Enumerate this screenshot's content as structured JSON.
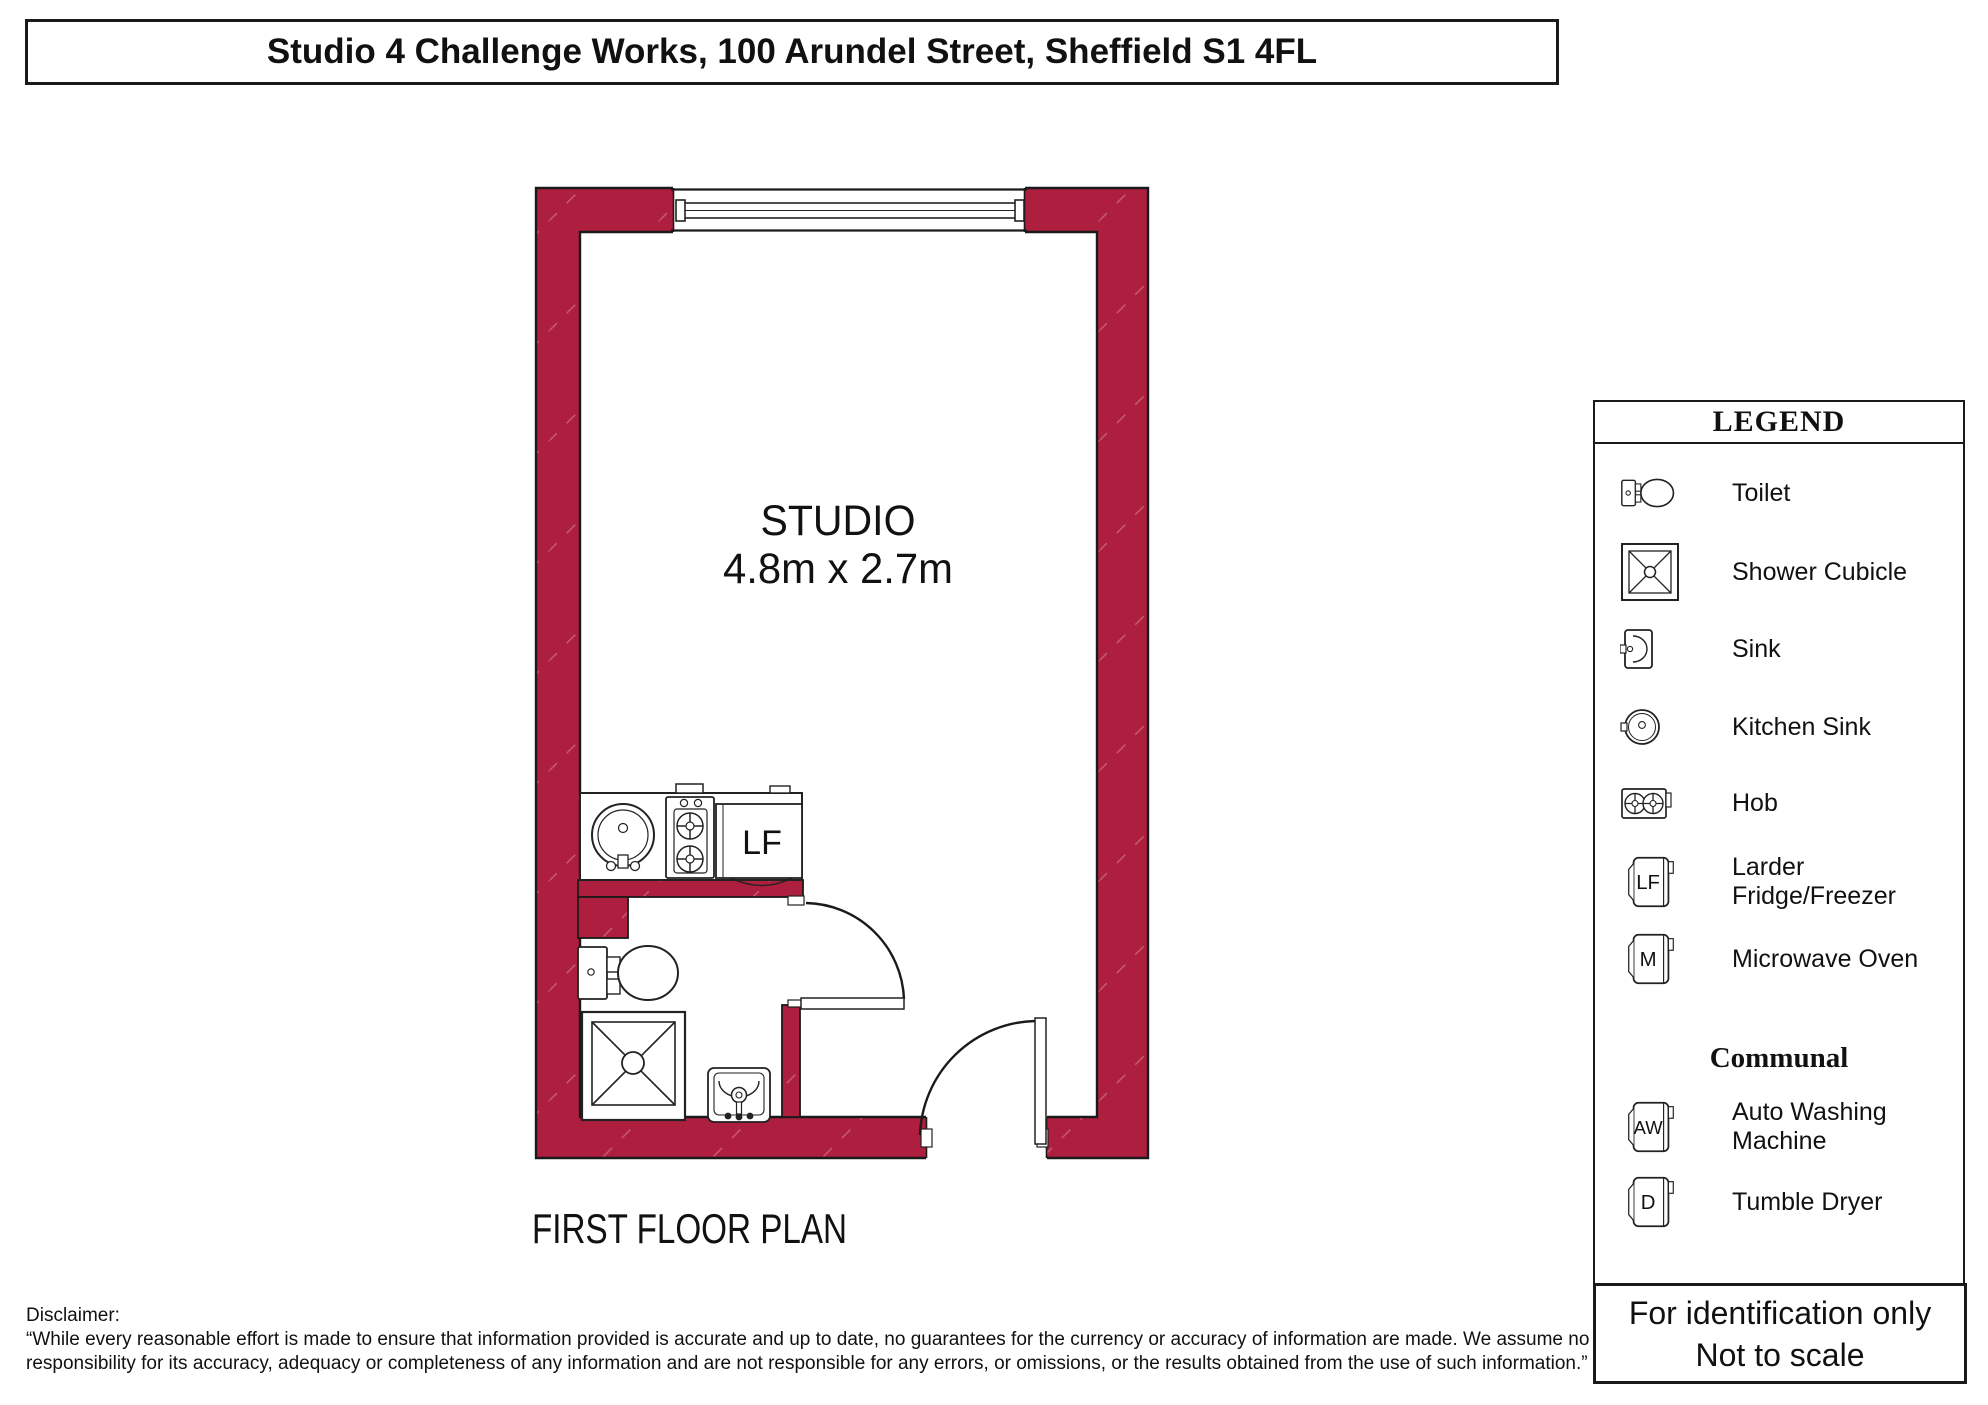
{
  "title": "Studio 4 Challenge Works, 100 Arundel Street, Sheffield S1 4FL",
  "plan": {
    "room_label": "STUDIO",
    "room_dimensions": "4.8m x 2.7m",
    "floor_label": "FIRST FLOOR PLAN",
    "fridge_label": "LF"
  },
  "legend": {
    "heading": "LEGEND",
    "items": [
      {
        "icon": "toilet-icon",
        "label": "Toilet"
      },
      {
        "icon": "shower-cubicle-icon",
        "label": "Shower Cubicle"
      },
      {
        "icon": "sink-icon",
        "label": "Sink"
      },
      {
        "icon": "kitchen-sink-icon",
        "label": "Kitchen Sink"
      },
      {
        "icon": "hob-icon",
        "label": "Hob"
      },
      {
        "icon": "larder-fridge-icon",
        "label": "Larder Fridge/Freezer",
        "letter": "LF"
      },
      {
        "icon": "microwave-icon",
        "label": "Microwave Oven",
        "letter": "M"
      }
    ],
    "communal_heading": "Communal",
    "communal_items": [
      {
        "icon": "washing-machine-icon",
        "label": "Auto Washing Machine",
        "letter": "AW"
      },
      {
        "icon": "tumble-dryer-icon",
        "label": "Tumble Dryer",
        "letter": "D"
      }
    ]
  },
  "footer": {
    "line1": "For identification only",
    "line2": "Not to scale"
  },
  "disclaimer": {
    "label": "Disclaimer:",
    "line1": "“While every reasonable effort is made to ensure that information provided is accurate and up to date, no guarantees for the currency or accuracy of information are made. We assume no",
    "line2": "responsibility for its accuracy, adequacy or completeness of any information and are not responsible for any errors, or omissions, or the results obtained from the use of such information.”"
  },
  "colors": {
    "wall_fill": "#ae1e3e",
    "wall_hatch": "#c65670",
    "outline": "#1a1a1a"
  }
}
